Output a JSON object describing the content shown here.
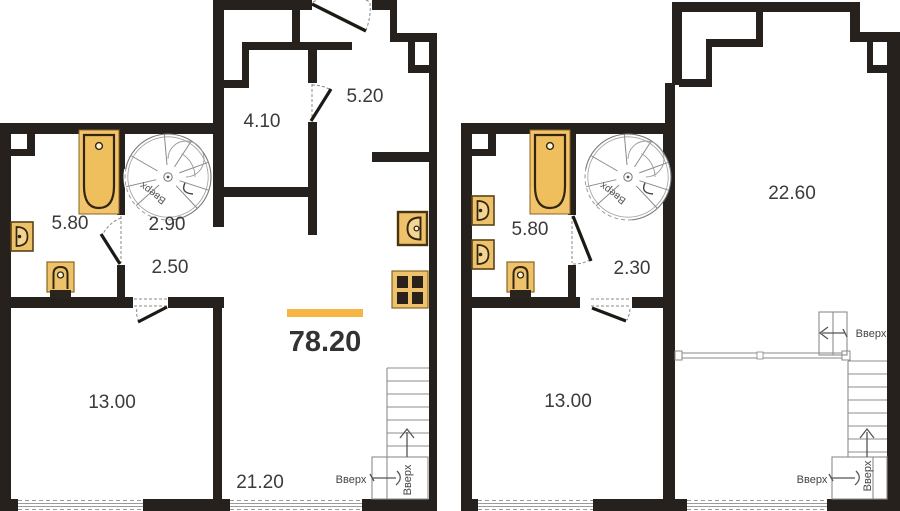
{
  "document": {
    "type": "apartment floor plan, two levels",
    "total_area": "78.20",
    "up_stairs_label": "Вверх"
  },
  "floor1": {
    "rooms": [
      {
        "id": "room-4-10",
        "area": "4.10"
      },
      {
        "id": "room-5-20",
        "area": "5.20"
      },
      {
        "id": "room-5-80",
        "area": "5.80"
      },
      {
        "id": "room-2-90",
        "area": "2.90"
      },
      {
        "id": "room-2-50",
        "area": "2.50"
      },
      {
        "id": "room-13-00",
        "area": "13.00"
      },
      {
        "id": "room-21-20",
        "area": "21.20"
      }
    ]
  },
  "floor2": {
    "rooms": [
      {
        "id": "room-5-80",
        "area": "5.80"
      },
      {
        "id": "room-2-30",
        "area": "2.30"
      },
      {
        "id": "room-22-60",
        "area": "22.60"
      },
      {
        "id": "room-13-00",
        "area": "13.00"
      }
    ]
  },
  "colors": {
    "wall": "#26211c",
    "fixture_fill": "#eec26b",
    "fixture_border": "#8a6420",
    "fixture_dark": "#33260f",
    "accent_bar": "#f6b643",
    "label_text": "#3b3b3b",
    "thin_line": "#8c8c8c"
  }
}
